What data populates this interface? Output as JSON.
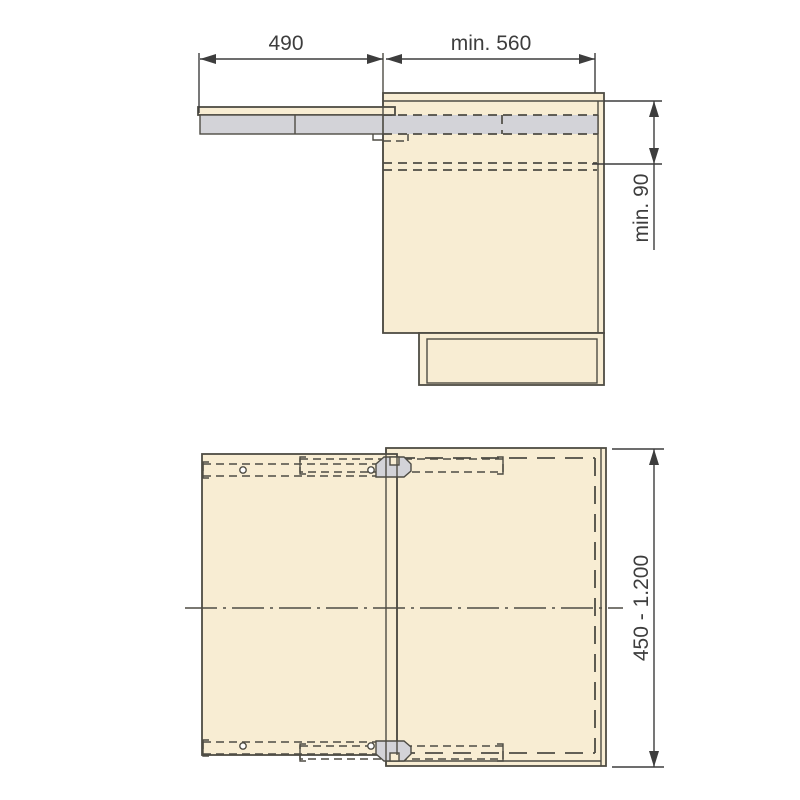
{
  "drawing": {
    "labels": {
      "pullout_extension": "490",
      "min_cabinet_depth": "min. 560",
      "min_top_clearance": "min. 90",
      "cabinet_width_range": "450 - 1.200"
    },
    "colors": {
      "background": "#ffffff",
      "wood": "#f8edd3",
      "rail": "#d3d3d8",
      "line": "#4e4c44",
      "dim": "#3d3d3d"
    }
  }
}
